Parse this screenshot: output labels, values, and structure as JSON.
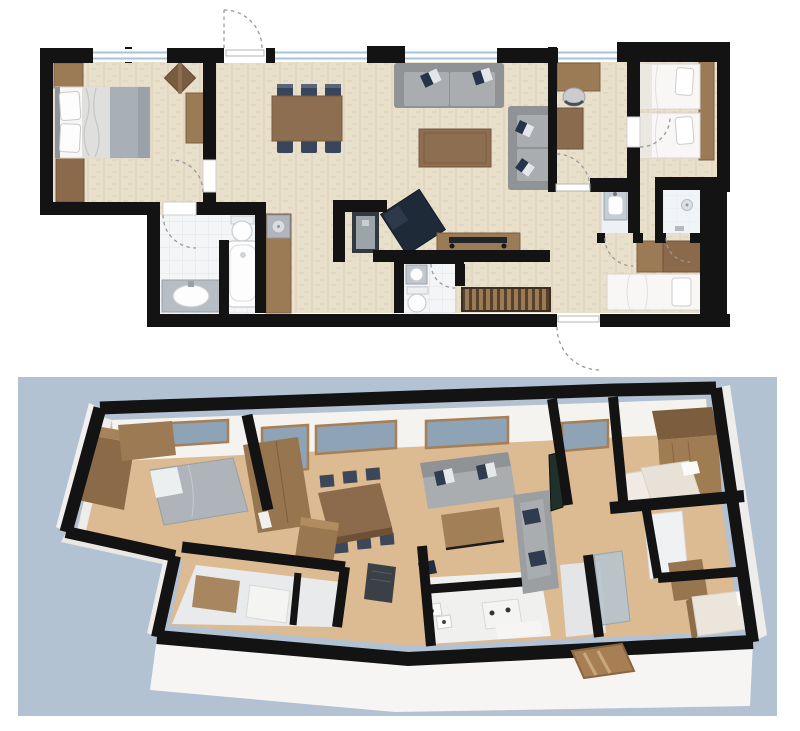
{
  "meta": {
    "description": "Apartment floor plan rendering with a 2D top-down plan above and a 3D isometric cutaway view below on a blue panel",
    "text_content": "none – image contains no visible text"
  },
  "views": {
    "plan2d": {
      "label": "2D floor plan (top view)"
    },
    "plan3d": {
      "label": "3D floor plan (isometric cutaway view)"
    }
  },
  "colors": {
    "page_bg": "#ffffff",
    "wall": "#131313",
    "floor": "#e9e0cc",
    "wood": "#9b7a56",
    "wood_dark": "#7c5f42",
    "table_wood": "#8d6e50",
    "navy": "#39455a",
    "navy_dark": "#202b3a",
    "sofa_gray": "#a9adb0",
    "sofa_gray_dark": "#8f9396",
    "bedding_white": "#f8f7f5",
    "blanket_gray": "#a9b0b5",
    "tile": "#f4f5f7",
    "tile_line": "#e0e4e9",
    "marble": "#b7bdc5",
    "glass2d": "#fbfdfe",
    "glass2d_line": "#a9c3d4",
    "bg3d": "#b2c2d2",
    "floor3d": "#dcba92",
    "wall3d": "#f4f3f0",
    "ext3d": "#f6f5f3",
    "glass3d": "#8ea3b5",
    "frame3d": "#a87f54",
    "tile3d": "#e8eaeb"
  },
  "rooms": {
    "master_bedroom": "Master bedroom",
    "living_dining": "Living and dining room",
    "kitchen": "Kitchen niche",
    "bathroom": "Bathroom with bathtub",
    "wc": "Guest WC",
    "hallway": "Entrance hallway",
    "study": "Study / office",
    "twin_bedroom": "Twin bedroom",
    "washroom": "Washroom with basin",
    "shower_room": "Shower room",
    "single_bedroom": "Single bedroom"
  },
  "furniture": {
    "double_bed": "Double bed",
    "wardrobe": "Wardrobe",
    "side_table": "Side table",
    "dresser": "Dresser",
    "dining_table": "Dining table with six chairs",
    "sofa": "Three-seat sofa",
    "loveseat": "Two-seat sofa",
    "coffee_table": "Coffee table",
    "armchair": "Dark armchair",
    "tv_board": "TV sideboard with flat-screen TV",
    "fridge": "Tall fridge cabinet",
    "kitchen_counter": "Kitchen counter with cooktop",
    "bathtub": "Bathtub",
    "toilet": "Toilet",
    "sink": "Washbasin",
    "doormat": "Slatted mat / shoe rack",
    "desk": "Desk with chair",
    "single_bed": "Single bed",
    "twin_beds": "Two single beds",
    "shower": "Walk-in shower"
  }
}
